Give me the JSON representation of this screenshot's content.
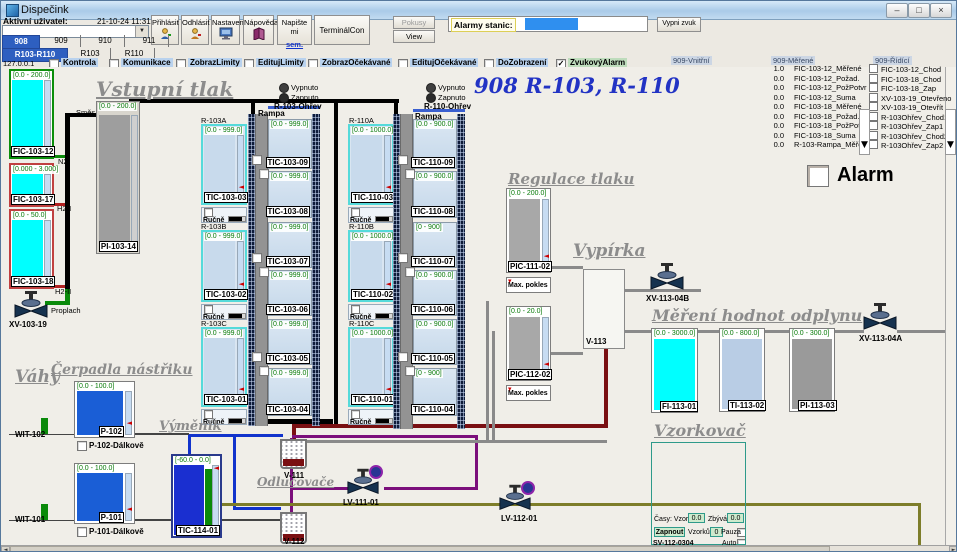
{
  "window": {
    "title": "Dispečink",
    "minimize": "–",
    "maximize": "□",
    "close": "×"
  },
  "icons": {
    "down": "▼",
    "left": "◄",
    "right": "►",
    "check": "✓",
    "mark": "◄"
  },
  "toolbar": {
    "active_user_label": "Aktivní uživatel:",
    "datetime": "21-10-24 11:31:53",
    "prihlasit": "Přihlásit",
    "odhlasit": "Odhlásit",
    "nastaveni": "Nastavení",
    "napoveda": "Nápověda",
    "napiste_1": "Napište mi",
    "napiste_2": "sem.",
    "terminal": "TerminálCon",
    "pokusy": "Pokusy",
    "view": "View",
    "alarmy_label": "Alarmy stanic:",
    "vypni_zvuk": "Vypni zvuk"
  },
  "tabs": {
    "t908": "908",
    "t909": "909",
    "t910": "910",
    "t911": "911",
    "r103r110": "R103-R110",
    "r103": "R103",
    "r110": "R110"
  },
  "options": {
    "ip": "127.0.0.1",
    "kontrola": "Kontrola",
    "komunikace": "Komunikace",
    "zobrazlimity": "ZobrazLimity",
    "editujlimity": "EditujLimity",
    "zobrazocek": "ZobrazOčekávané",
    "editujocek": "EditujOčekávané",
    "dozobrazeni": "DoZobrazení",
    "zvukovyalarm": "ZvukovýAlarm"
  },
  "headings": {
    "vstupni_tlak": "Vstupní tlak",
    "main_title": "908 R-103, R-110",
    "regulace": "Regulace tlaku",
    "vypirka": "Vypírka",
    "mereni": "Měření hodnot odplynu",
    "vahy": "Váhy",
    "cerpadla": "Čerpadla nástřiku",
    "vymenik": "Výměník",
    "odlucovace": "Odlučovače",
    "vzorkovac": "Vzorkovač",
    "alarm": "Alarm"
  },
  "reactors": {
    "r103a": "R-103A",
    "r103b": "R-103B",
    "r103c": "R-103C",
    "r110a": "R-110A",
    "r110b": "R-110B",
    "r110c": "R-110C",
    "rampa": "Rampa",
    "rucne": "Ručně",
    "vypnuto": "Vypnuto",
    "zapnuto": "Zapnuto",
    "r103_ohrev": "R-103-Ohřev",
    "r110_ohrev": "R-110-Ohřev"
  },
  "gauges": {
    "fic_103_12": {
      "range": "[0.0 - 200.0]",
      "label": "FIC-103-12"
    },
    "fic_103_17": {
      "range": "[0.000 - 3.000]",
      "label": "FIC-103-17"
    },
    "fic_103_18": {
      "range": "[0.0 - 50.0]",
      "label": "FIC-103-18"
    },
    "pi_103_14": {
      "range": "[0.0 - 200.0]",
      "label": "PI-103-14"
    },
    "tic_103_01": {
      "range": "[0.0 - 999.0]",
      "label": "TIC-103-01"
    },
    "tic_103_02": {
      "range": "[0.0 - 999.0]",
      "label": "TIC-103-02"
    },
    "tic_103_03": {
      "range": "[0.0 - 999.0]",
      "label": "TIC-103-03"
    },
    "tic_103_04": {
      "range": "[0.0 - 999.0]",
      "label": "TIC-103-04"
    },
    "tic_103_05": {
      "range": "[0.0 - 999.0]",
      "label": "TIC-103-05"
    },
    "tic_103_06": {
      "range": "[0.0 - 999.0]",
      "label": "TIC-103-06"
    },
    "tic_103_07": {
      "range": "[0.0 - 999.0]",
      "label": "TIC-103-07"
    },
    "tic_103_08": {
      "range": "[0.0 - 999.0]",
      "label": "TIC-103-08"
    },
    "tic_103_09": {
      "range": "[0.0 - 999.0]",
      "label": "TIC-103-09"
    },
    "tic_110_01": {
      "range": "[0.0 - 1000.0]",
      "label": "TIC-110-01"
    },
    "tic_110_02": {
      "range": "[0.0 - 1000.0]",
      "label": "TIC-110-02"
    },
    "tic_110_03": {
      "range": "[0.0 - 1000.0]",
      "label": "TIC-110-03"
    },
    "tic_110_04": {
      "range": "[0 - 900]",
      "label": "TIC-110-04"
    },
    "tic_110_05": {
      "range": "[0.0 - 900.0]",
      "label": "TIC-110-05"
    },
    "tic_110_06": {
      "range": "[0.0 - 900.0]",
      "label": "TIC-110-06"
    },
    "tic_110_07": {
      "range": "[0 - 900]",
      "label": "TIC-110-07"
    },
    "tic_110_08": {
      "range": "[0.0 - 900.0]",
      "label": "TIC-110-08"
    },
    "tic_110_09": {
      "range": "[0.0 - 900.0]",
      "label": "TIC-110-09"
    },
    "pic_111_02": {
      "range": "[0.0 - 200.0]",
      "label": "PIC-111-02",
      "sub": "Max. pokles"
    },
    "pic_112_02": {
      "range": "[0.0 - 20.0]",
      "label": "PIC-112-02",
      "sub": "Max. pokles"
    },
    "fi_113_01": {
      "range": "[0.0 - 3000.0]",
      "label": "FI-113-01"
    },
    "ti_113_02": {
      "range": "[0.0 - 800.0]",
      "label": "TI-113-02"
    },
    "pi_113_03": {
      "range": "[0.0 - 300.0]",
      "label": "PI-113-03"
    },
    "p_102": {
      "range": "[0.0 - 100.0]",
      "label": "P-102",
      "remote": "P-102-Dálkově"
    },
    "p_101": {
      "range": "[0.0 - 100.0]",
      "label": "P-101",
      "remote": "P-101-Dálkově"
    },
    "tic_114_01": {
      "range": "[-60.0 - 0.0]",
      "label": "TIC-114-01"
    }
  },
  "equipment": {
    "xv_103_19": "XV-103-19",
    "v_111": "V-111",
    "v_112": "V-112",
    "v_113": "V-113",
    "lv_111_01": "LV-111-01",
    "lv_112_01": "LV-112-01",
    "xv_113_04a": "XV-113-04A",
    "xv_113_04b": "XV-113-04B",
    "wit_101": "WIT-101",
    "wit_102": "WIT-102"
  },
  "pipe_labels": {
    "smes": "Směs",
    "n2": "N2",
    "h2_i": "H2-I",
    "h2_ii": "H2-II",
    "proplach": "Proplach"
  },
  "sampler": {
    "casy_label": "Časy: Vzorku",
    "sample_time": "0.0",
    "zbyva_label": "Zbývá:",
    "remaining": "0.0",
    "zapnout": "Zapnout",
    "vzorku_label": "Vzorků:",
    "count": "0",
    "pauza": "Pauza",
    "auto": "Auto",
    "device": "SV-112-0304"
  },
  "right_panel": {
    "vnitrni_label": "909-Vnitřní",
    "merene_label": "909-Měřené",
    "ridici_label": "909-Řídící",
    "merene": [
      {
        "value": "1.0",
        "name": "FIC-103-12_Měřené"
      },
      {
        "value": "0.0",
        "name": "FIC-103-12_Požad."
      },
      {
        "value": "0.0",
        "name": "FIC-103-12_PožPotvr"
      },
      {
        "value": "0.0",
        "name": "FIC-103-12_Suma"
      },
      {
        "value": "0.0",
        "name": "FIC-103-18_Měřené"
      },
      {
        "value": "0.0",
        "name": "FIC-103-18_Požad."
      },
      {
        "value": "0.0",
        "name": "FIC-103-18_PožPotvr"
      },
      {
        "value": "0.0",
        "name": "FIC-103-18_Suma"
      },
      {
        "value": "0.0",
        "name": "R-103-Rampa_Měřené"
      }
    ],
    "ridici": [
      "FIC-103-12_Chod",
      "FIC-103-18_Chod",
      "FIC-103-18_Zap",
      "XV-103-19_Otevřeno",
      "XV-103-19_Otevřít",
      "R-103Ohřev_Chod1",
      "R-103Ohřev_Zap1",
      "R-103Ohřev_Chod2",
      "R-103Ohřev_Zap2"
    ]
  },
  "colors": {
    "selected_tab": "#2e5fc0",
    "title_blue": "#2233c4",
    "cyan_bar": "#00ffff",
    "blue_bar": "#1a5ed6",
    "green_bar": "#0a8a0a",
    "gray_bar": "#9e9e9e",
    "maroon_pipe": "#7a0f12",
    "purple_pipe": "#7b0f7b",
    "olive_pipe": "#7d7d2a"
  }
}
